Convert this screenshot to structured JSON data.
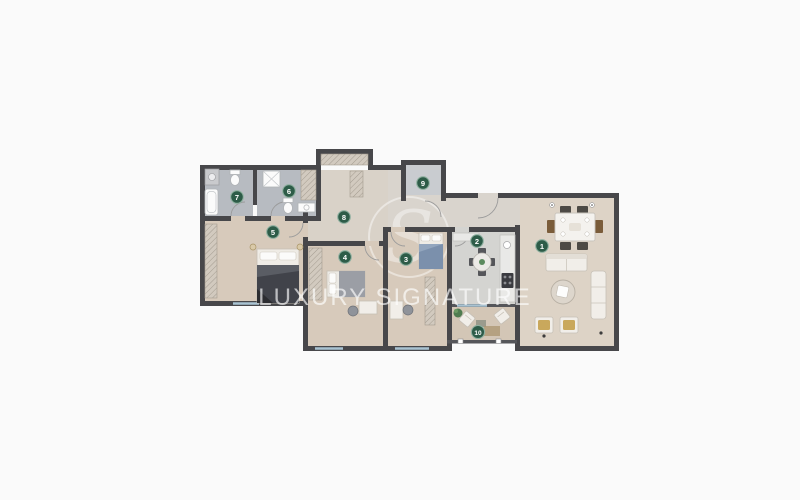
{
  "watermark": {
    "brand": "LUXURY SIGNATURE",
    "logo_letter": "S"
  },
  "rooms": [
    {
      "number": "1"
    },
    {
      "number": "2"
    },
    {
      "number": "3"
    },
    {
      "number": "4"
    },
    {
      "number": "5"
    },
    {
      "number": "6"
    },
    {
      "number": "7"
    },
    {
      "number": "8"
    },
    {
      "number": "9"
    },
    {
      "number": "10"
    }
  ],
  "colors": {
    "background": "#fafafa",
    "wall": "#47474a",
    "badge_green": "#2d5c48",
    "badge_ring": "#8fb0a0",
    "floor_bedroom": "#d7cabb",
    "floor_bath": "#b7bbc1",
    "floor_hall": "#d9d2c8",
    "floor_entry": "#d9d4cd",
    "floor_kitchen": "#d4d4d1",
    "floor_living": "#ddd3c6",
    "floor_balcony": "#d3c6b6",
    "floor_niche": "#c9ccd0",
    "window_blue": "#a9c3d2"
  }
}
